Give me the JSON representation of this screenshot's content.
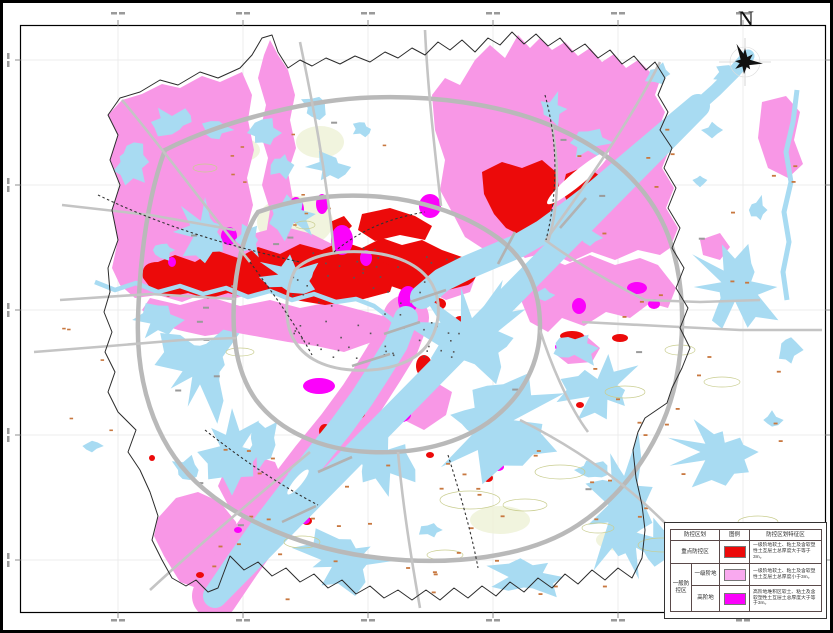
{
  "map": {
    "compass_label": "N"
  },
  "legend": {
    "header": {
      "zoning": "防控区划",
      "symbol": "图例",
      "feature": "防控区划特征区"
    },
    "group_label": "一般防控区",
    "rows": [
      {
        "label": "重点防控区",
        "color": "#EC0A0A",
        "desc": "一级阶地软土、粘土及含软塑性土互层土总厚度大于等于3m。"
      },
      {
        "label": "一级阶地",
        "color": "#F9A9EF",
        "desc": "一级阶地软土、粘土及含软塑性土互层土总厚度小于3m。"
      },
      {
        "label": "高阶地",
        "color": "#FB02FB",
        "desc": "高阶地堆积区软土、粘土及含软塑性土互层土总厚度大于等于3m。"
      }
    ]
  },
  "colors": {
    "key_zone_red": "#EC0A0A",
    "general_zone_pink": "#F897E6",
    "high_terrace_magenta": "#FB02FB",
    "water_blue": "#A8DBF2",
    "road_gray": "#C4C4C4",
    "road_major_gray": "#B9B9B9",
    "boundary_black": "#2B2B2B",
    "grid_gray": "#ECECEC",
    "contour_olive": "#C9CD8F",
    "marker_orange": "#C87840"
  }
}
